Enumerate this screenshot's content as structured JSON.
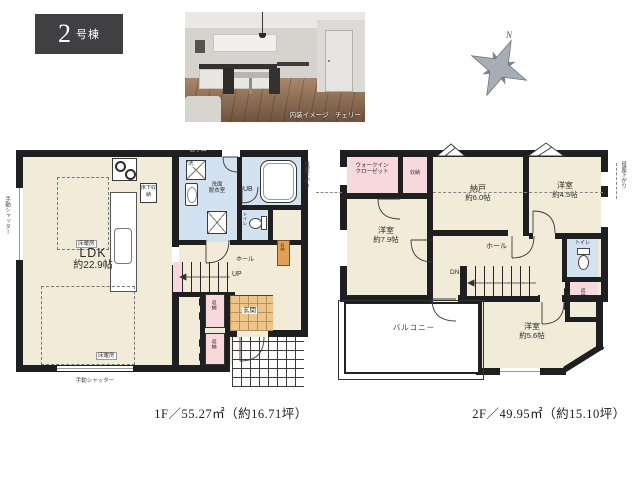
{
  "badge": {
    "number": "2",
    "suffix": "号棟"
  },
  "photo": {
    "caption": "内装イメージ　チェリー"
  },
  "compass": {
    "north_label": "N"
  },
  "floor1": {
    "area_caption": "1F／55.27㎡（約16.71坪）",
    "ldk_name": "LDK",
    "ldk_size": "約22.9帖",
    "floor_heating_top": "床暖房",
    "floor_heating_bottom": "床暖房",
    "underfloor_storage": "床下収納",
    "washer_mark": "洗",
    "washroom_line1": "洗面",
    "washroom_line2": "脱衣室",
    "unit_bath": "UB",
    "toilet": "トイレ",
    "hall": "ホール",
    "stairs_up": "UP",
    "entrance": "玄関",
    "closet_upper": "収納",
    "closet_lower": "収納",
    "entrance_storage": "収納",
    "shutter_left": "手動シャッター",
    "shutter_bottom": "手動シャッター",
    "back_door": "勝手口"
  },
  "floor2": {
    "area_caption": "2F／49.95㎡（約15.10坪）",
    "wic_line1": "ウォークイン",
    "wic_line2": "クローゼット",
    "closet_top": "収納",
    "storage_room_name": "納戸",
    "storage_room_size": "約6.0帖",
    "bedroom_a_name": "洋室",
    "bedroom_a_size": "約7.9帖",
    "bedroom_b_name": "洋室",
    "bedroom_b_size": "約4.5帖",
    "bedroom_c_name": "洋室",
    "bedroom_c_size": "約5.6帖",
    "hall": "ホール",
    "stairs_down": "DN",
    "toilet": "トイレ",
    "balcony": "バルコニー",
    "closet_side": "収納",
    "roof_note_left": "母屋下がり",
    "roof_note_right": "母屋下がり"
  }
}
